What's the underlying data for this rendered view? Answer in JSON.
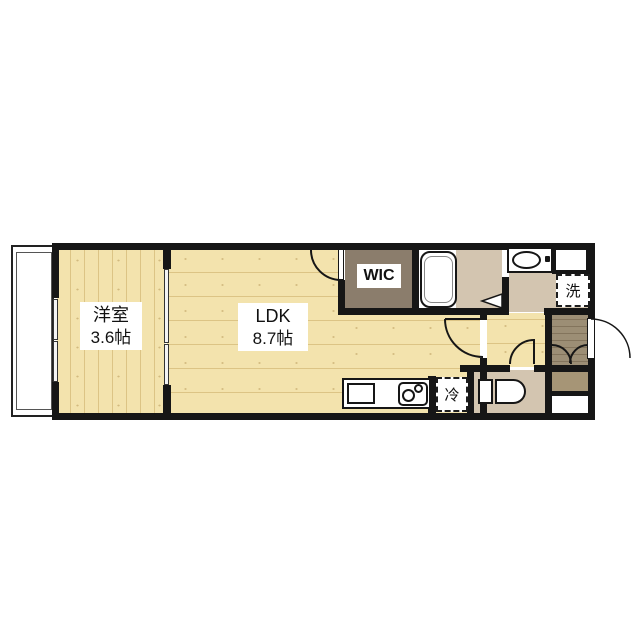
{
  "floorplan": {
    "rooms": [
      {
        "name": "洋室",
        "size": "3.6帖"
      },
      {
        "name": "LDK",
        "size": "8.7帖"
      },
      {
        "name": "WIC",
        "size": ""
      }
    ],
    "appliance_spaces": [
      {
        "label": "洗"
      },
      {
        "label": "冷"
      }
    ],
    "colors": {
      "wall": "#161616",
      "wood": "#f3e3ad",
      "wic-floor": "#8b7d6c",
      "tan-floor": "#d3c5b0",
      "entry-tile": "#9c8e75",
      "entry-tile-dark": "#83745c",
      "cabinet": "#a69576"
    }
  }
}
